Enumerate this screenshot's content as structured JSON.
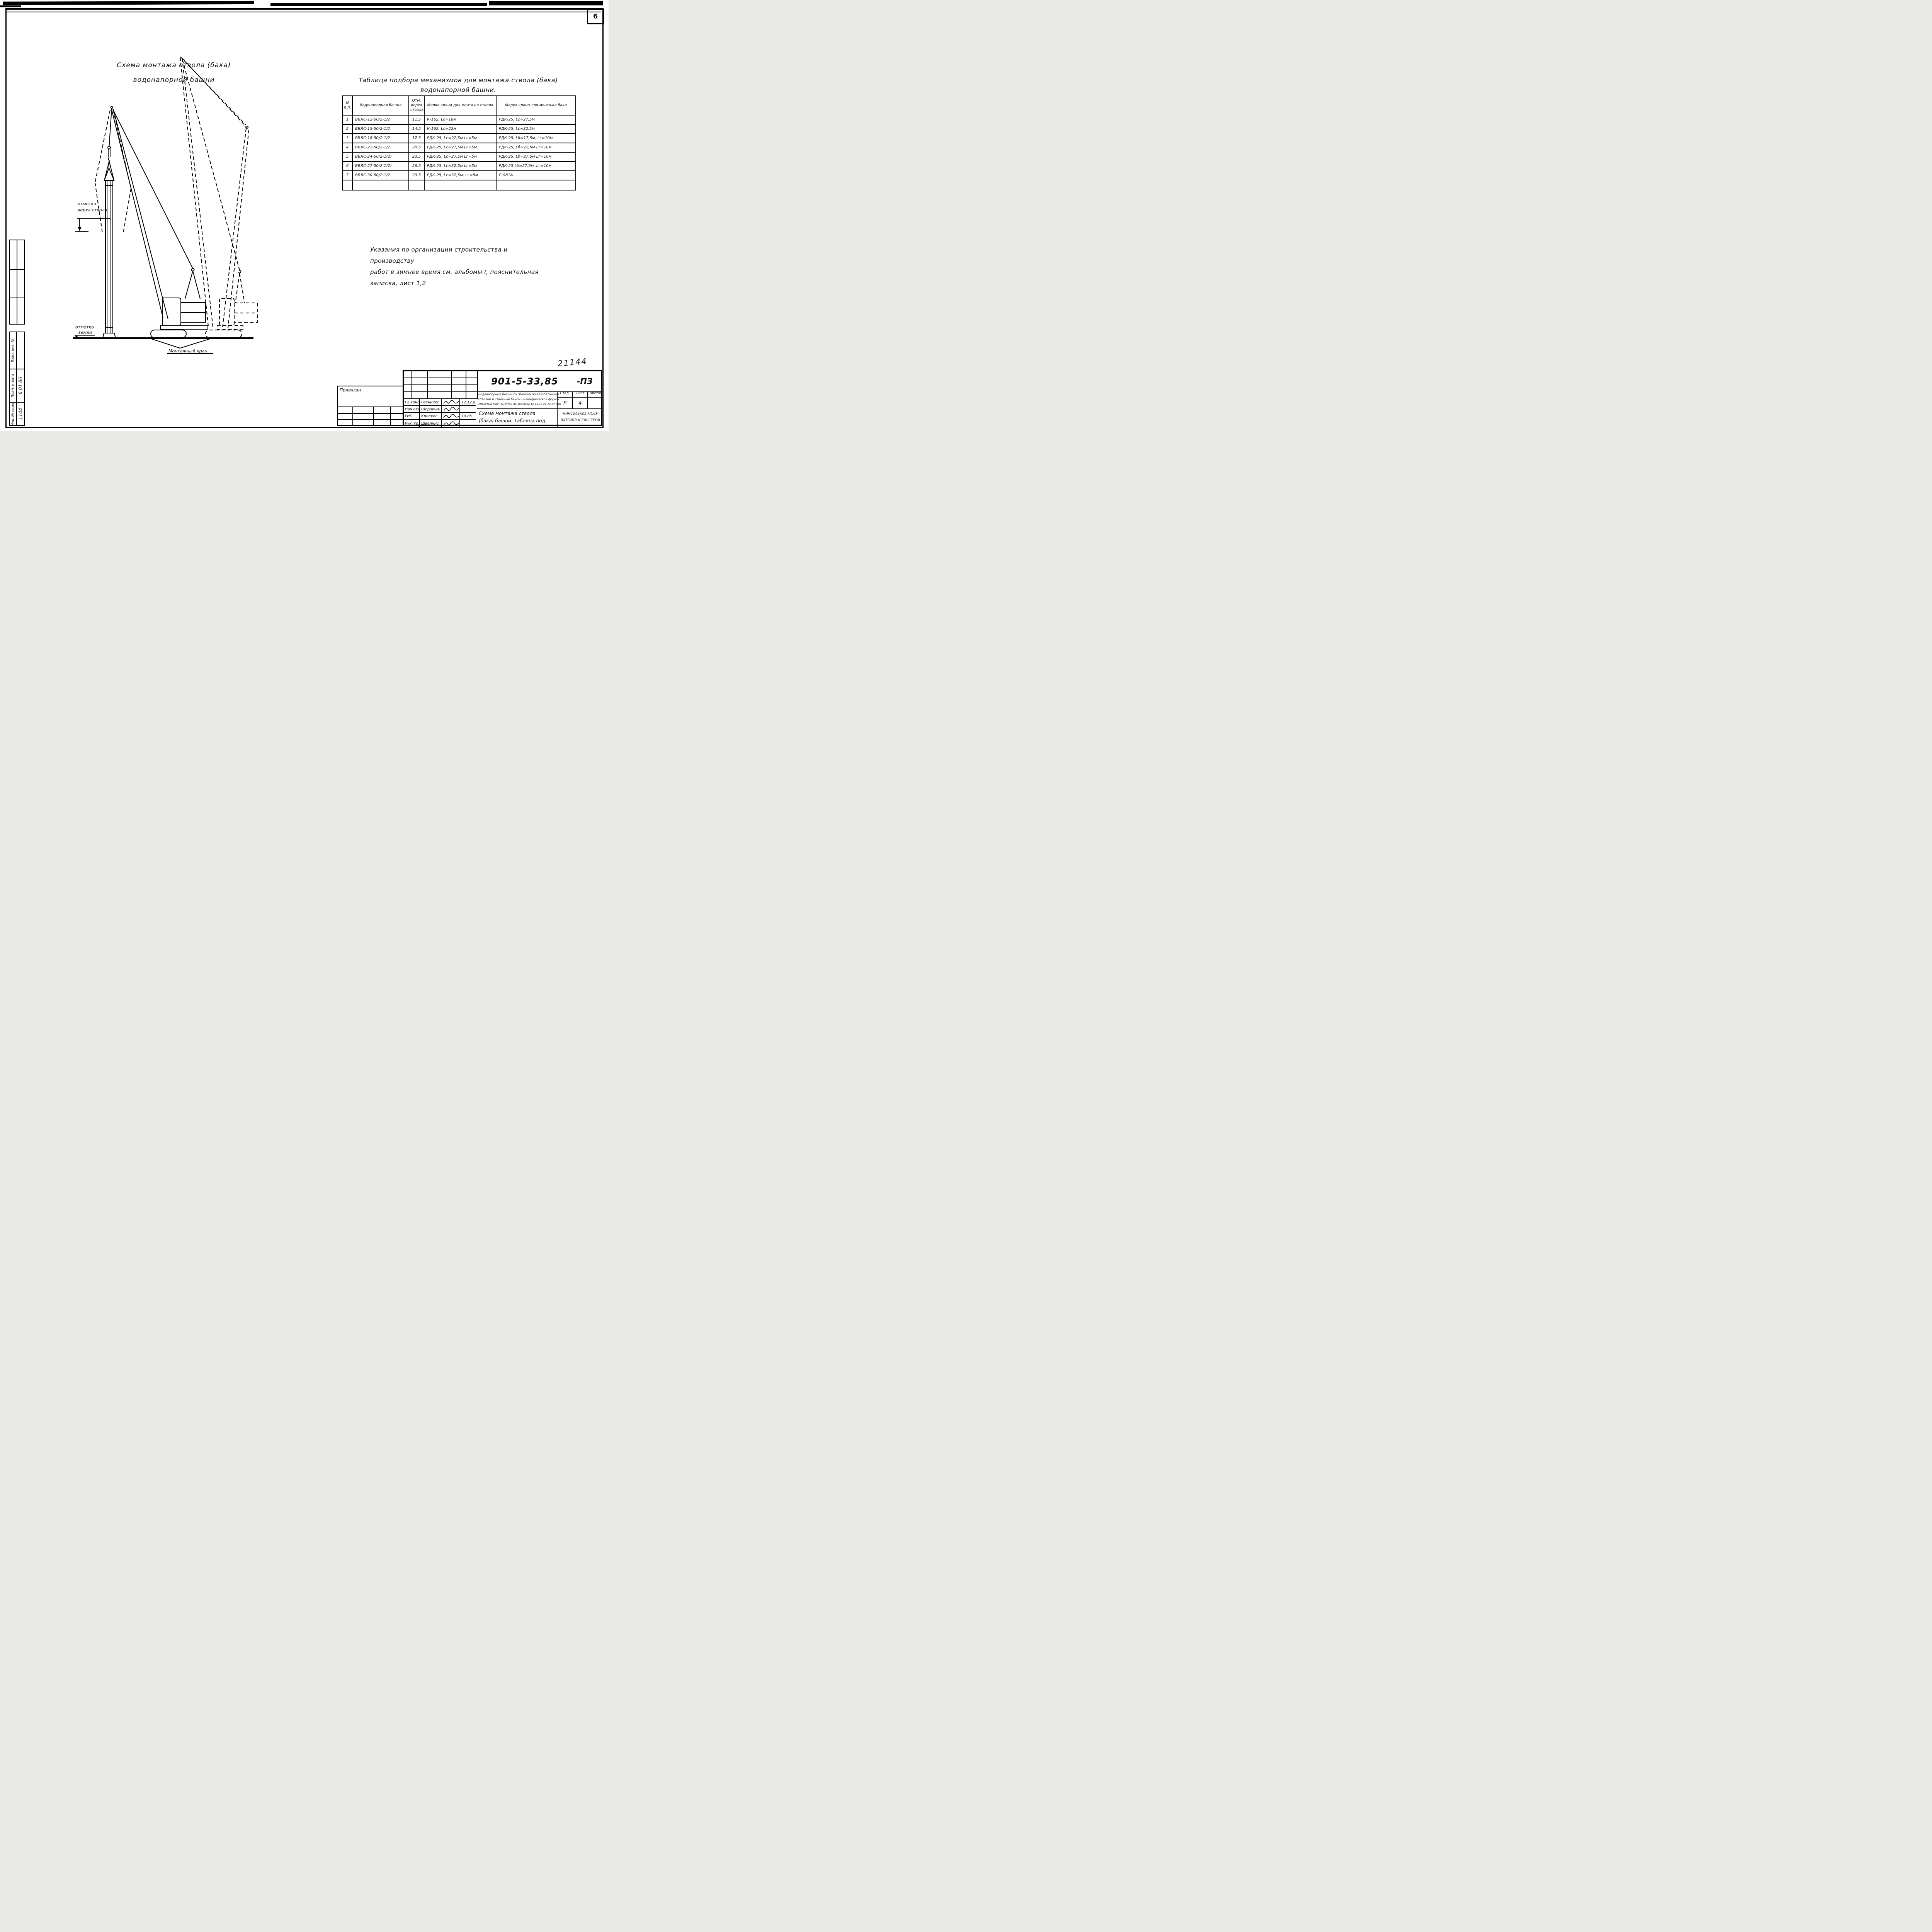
{
  "page": {
    "number": "6",
    "handwritten_number": "21144"
  },
  "drawing": {
    "title_line1": "Схема монтажа ствола (бака)",
    "title_line2": "водонапорной башни",
    "labels": {
      "top_mark_line1": "отметка",
      "top_mark_line2": "верха ствола",
      "ground_mark_line1": "отметка",
      "ground_mark_line2": "земли",
      "crane": "Монтажный кран"
    }
  },
  "table": {
    "title_line1": "Таблица подбора механизмов для монтажа ствола (бака)",
    "title_line2": "водонапорной башни.",
    "headers": [
      "N п.п.",
      "Водонапорная башня",
      "Отм. верха ствола",
      "Марка крана для монтажа ствола",
      "Марка крана для монтажа бака"
    ],
    "rows": [
      [
        "1",
        "ВБЛС-12-50/2-1/2",
        "11.5",
        "К-162, Lс=18м",
        "РДК-25, Lс=27,5м"
      ],
      [
        "2",
        "ВБЛС-15-50/2-1/2",
        "14.5",
        "К-162, Lс=22м",
        "РДК-25, Lс=32,5м"
      ],
      [
        "3",
        "ВБЛС-18-50/2-1/2",
        "17.5",
        "РДК-25, Lс=22,5м Lг=5м",
        "РДК-25, Lб=17,5м, Lг=10м"
      ],
      [
        "4",
        "ВБЛС-21-50/2-1/2",
        "20.5",
        "РДК-25, Lс=27,5м Lг=5м",
        "РДК-25, Lб=22,5м Lг=10м"
      ],
      [
        "5",
        "ВБЛС-24-50/2-1(2)",
        "23.5",
        "РДК-25, Lс=27,5м Lг=5м",
        "РДК-25, Lб=27,5м Lг=10м"
      ],
      [
        "6",
        "ВБЛС-27-50/2-1(2)",
        "26.5",
        "РДК-25, Lс=32,5м Lг=5м",
        "РДК-25 Lб=27,5м, Lг=10м"
      ],
      [
        "7",
        "ВБЛС-30-50/2-1/2",
        "29.5",
        "РДК-25, Lс=32,5м, Lг=5м",
        "С-981А"
      ]
    ]
  },
  "notes": {
    "line1": "Указания по организации строительства и производству",
    "line2": "работ в зимнее время см. альбомы I, пояснительная",
    "line3": "записка, лист 1,2"
  },
  "stamp": {
    "doc_number": "901-5-33,85",
    "doc_suffix": "-ПЗ",
    "description_line1": "Водонапорные башни со сборным железобетонным",
    "description_line2": "стволом и стальным баком цилиндрической формы",
    "description_line3": "емкостью 50м³, высотой до дна бака 12,15,18,21,24,27,30м",
    "stage_label": "Стад.",
    "sheet_label": "Лист",
    "sheets_label": "Листов",
    "stage_value": "Р",
    "sheet_value": "4",
    "sheets_value": "",
    "signatures": [
      {
        "role": "Гл.констр",
        "name": "Ратниекс",
        "date": "12.12.83"
      },
      {
        "role": "Нач отд",
        "name": "Шершень",
        "date": ""
      },
      {
        "role": "ГИП",
        "name": "Криекис",
        "date": "10.85"
      },
      {
        "role": "Рук. гр.",
        "name": "Швелнис",
        "date": ""
      }
    ],
    "sheet_title_line1": "Схема монтажа ствола",
    "sheet_title_line2": "(бака) башни. Таблица под.",
    "org_line1": "минсельхоз ЛССР",
    "org_line2": "ЛАТГИПРОСЕЛЬСТРОЙ",
    "attach_label": "Привязан"
  },
  "sidebar": {
    "vzam_label": "Взам. инв. №",
    "podp_label": "Подп. и дата",
    "podp_value": "6 01 86",
    "inv_label": "Инв. № подл.",
    "inv_value": "1144"
  }
}
